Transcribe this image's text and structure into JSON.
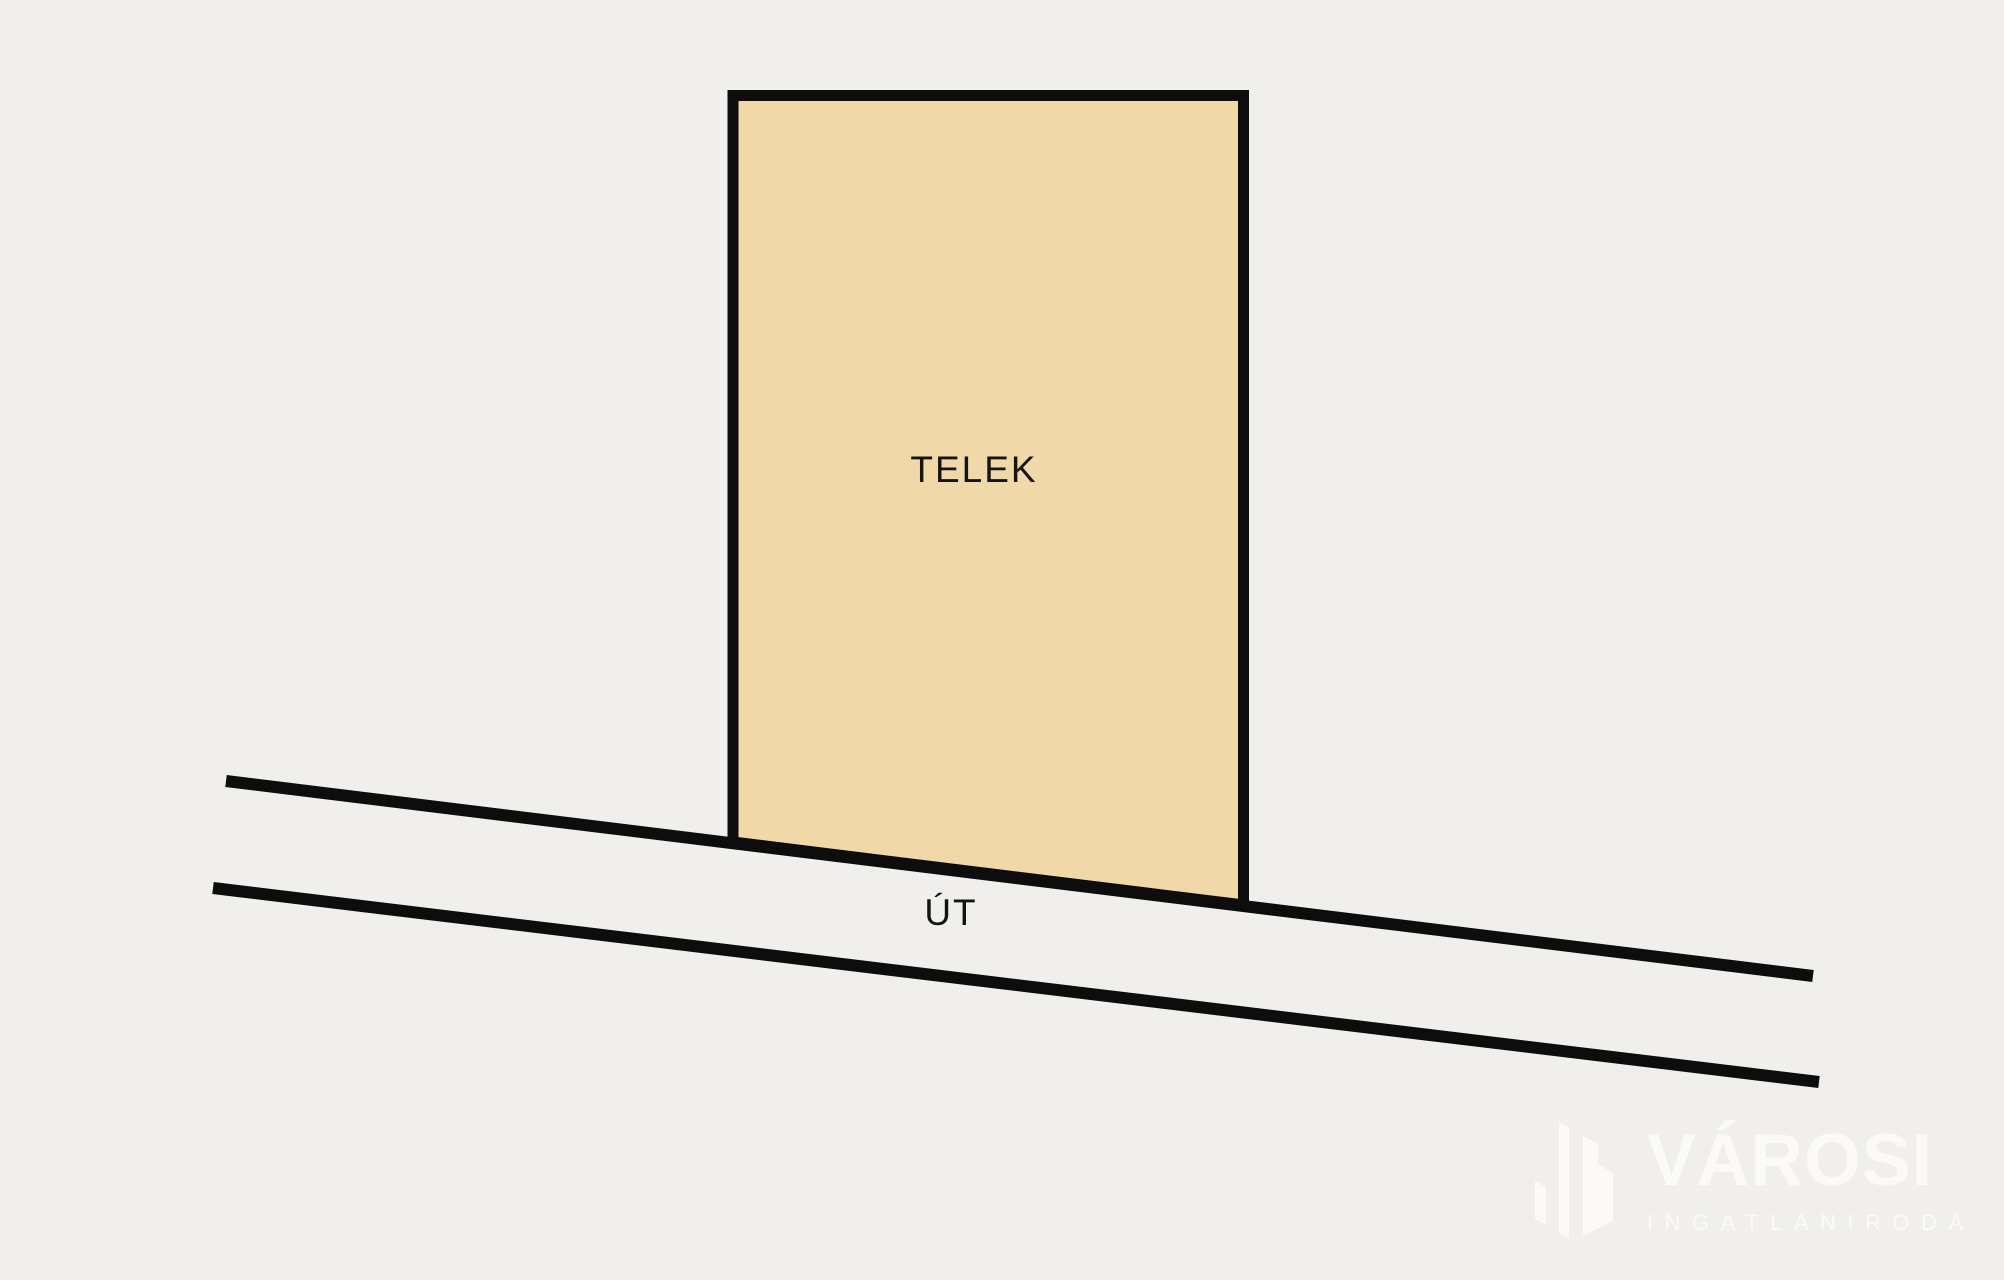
{
  "colors": {
    "background": "#f0efeb",
    "line": "#0d0d0d",
    "plot_fill": "#f1d8a9",
    "text": "#141414",
    "logo": "#fbfaf7"
  },
  "plot": {
    "label": "TELEK"
  },
  "road": {
    "label": "ÚT"
  },
  "logo": {
    "brand": "VÁROSI",
    "subtitle": "INGATLANIRODA",
    "icon": "buildings-icon"
  }
}
